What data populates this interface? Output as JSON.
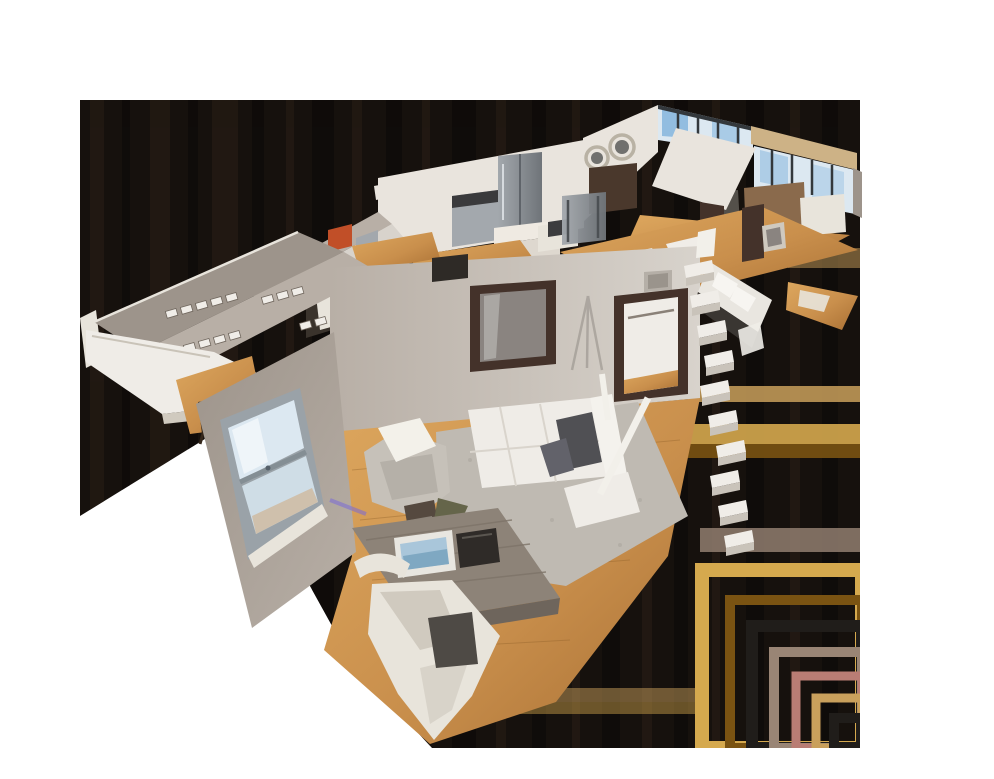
{
  "scene": {
    "type": "3d-dollhouse-view",
    "subject": "Cutaway photogrammetry dollhouse scan of a one-bedroom apartment, viewed obliquely from above; apartment runs diagonally from lower-left to upper-right over a dark compression-artifact halo on a white page",
    "background": "#ffffff",
    "interaction": "drag-to-orbit 3d model"
  },
  "rooms": [
    {
      "id": "bedroom",
      "label": "bedroom",
      "contents": [
        "white double bed",
        "two dark gray pillows",
        "speckled area rug",
        "gray tufted armchair with white throw",
        "wood desk with laptop and dark bag",
        "white desk chair (fragmented scan tail)",
        "sash window with sky view",
        "dark mirrored door",
        "closet doorway with hanging rod",
        "tripod shadow on wall",
        "purple LED baseboard glow"
      ]
    },
    {
      "id": "closet-wing",
      "label": "walk-in closet wing",
      "contents": [
        "rows of white shelf brackets on gray walls",
        "white folded table slab",
        "wood floor patch",
        "dark stool"
      ]
    },
    {
      "id": "kitchen",
      "label": "kitchen",
      "contents": [
        "stainless refrigerator",
        "stainless stove",
        "white countertop",
        "small dining table with dark laptop",
        "steel console",
        "red wall accent"
      ]
    },
    {
      "id": "living-room",
      "label": "living room",
      "contents": [
        "floor-to-ceiling windows with blue sky",
        "two round metal mirrors",
        "tan ceiling beam",
        "dark sideboard",
        "brown desk",
        "white partition"
      ]
    },
    {
      "id": "bathroom",
      "label": "bathroom",
      "contents": [
        "white double vanity",
        "dark cabinet",
        "framed print",
        "hanging towel"
      ]
    },
    {
      "id": "stairs",
      "label": "white open staircase (fragmented scan)",
      "contents": [
        "zig-zag white steps"
      ]
    },
    {
      "id": "hallway",
      "label": "hallway",
      "contents": [
        "golden wood floor",
        "white runner rugs",
        "dark door"
      ]
    }
  ],
  "palette": {
    "page_bg": "#ffffff",
    "shadow_base": "#16110d",
    "streak_light": "#2a1f17",
    "streak_dark": "#0b0908",
    "band_tan": "#c9a05c",
    "band_gold": "#d5a94e",
    "band_brown": "#7a5312",
    "band_mauve": "#998575",
    "band_rose": "#b97d74",
    "band_dark": "#201d1a",
    "wall_dark": "#9d948b",
    "wall_mid": "#b8afa6",
    "wall_light": "#d8d3cc",
    "wall_white": "#e9e4dd",
    "floor_wood": "#c98f4c",
    "floor_wood_light": "#dda75e",
    "floor_wood_dark": "#a86f33",
    "rug_gray": "#bfbab2",
    "bed_white": "#efece7",
    "bed_shadow": "#d9d4cc",
    "pillow_dark": "#505054",
    "window_frame": "#9aa2a8",
    "window_sky": "#dce8f1",
    "window_blue": "#7fb2dc",
    "window_building": "#cfc0ac",
    "mullion_dark": "#33383c",
    "beam_tan": "#cdb286",
    "steel": "#a3a8ad",
    "steel_dark": "#6f7479",
    "dark_frame": "#44322a",
    "red_accent": "#c14f28",
    "chair_white": "#e8e4db",
    "chair_shade": "#d0cabf",
    "desk_wood": "#8d8378",
    "desk_front": "#6e655c",
    "bag_dark": "#2f2b28",
    "laptop_screen": "#a9c6da",
    "laptop_image": "#7fa8c2",
    "glow_purple": "#7a6ad8",
    "mirror_metal": "#b9b2a4",
    "mirror_glass": "#70706e",
    "art_gray": "#8a8480",
    "stair_white": "#f0ede8",
    "stair_shadow": "#c9c3ba",
    "vanity_dark": "#3a3632",
    "sofa_brown": "#8a6a4c",
    "sideboard_dark": "#4a382c"
  }
}
